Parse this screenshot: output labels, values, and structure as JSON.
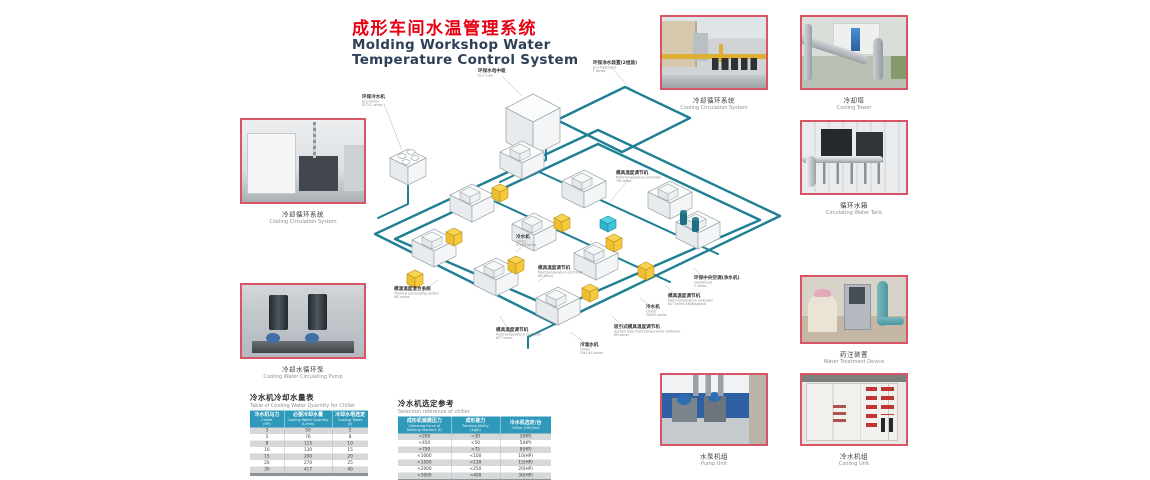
{
  "header": {
    "title_zh": "成形车间水温管理系统",
    "title_en1": "Molding Workshop Water",
    "title_en2": "Temperature Control System"
  },
  "colors": {
    "accent_red": "#e60012",
    "title_blue": "#2e4057",
    "photo_border": "#d95565",
    "pipe_teal": "#1e7f95",
    "controller_yellow": "#f2c53d",
    "table_header_blue": "#2e99ba"
  },
  "photos": [
    {
      "caption_zh": "冷却循环系统",
      "caption_en": "Cooling Circulation System"
    },
    {
      "caption_zh": "冷却水循环泵",
      "caption_en": "Cooling Water Circulating Pump"
    },
    {
      "caption_zh": "冷却循环系统",
      "caption_en": "Cooling Circulation System"
    },
    {
      "caption_zh": "冷却塔",
      "caption_en": "Cooling Tower"
    },
    {
      "caption_zh": "循环水箱",
      "caption_en": "Circulating Water Tank"
    },
    {
      "caption_zh": "药注装置",
      "caption_en": "Water Treatment Device"
    },
    {
      "caption_zh": "水泵机组",
      "caption_en": "Pump Unit"
    },
    {
      "caption_zh": "冷水机组",
      "caption_en": "Cooling Unit"
    }
  ],
  "diagram": {
    "labels": [
      {
        "zh": "环保净水装置(2组装)",
        "en1": "Eco-treatment",
        "en2": "F series"
      },
      {
        "zh": "环保水电中枢",
        "en1": "Eco Cube",
        "en2": ""
      },
      {
        "zh": "环保冷水机",
        "en1": "Eco-Chiller",
        "en2": "ECO-C series"
      },
      {
        "zh": "模具温度调节机",
        "en1": "Mold temperature controller",
        "en2": "TW series"
      },
      {
        "zh": "冷水机",
        "en1": "Chiller",
        "en2": "CH-KS series"
      },
      {
        "zh": "模具温度调节机",
        "en1": "Mold temperature controller",
        "en2": "KD series"
      },
      {
        "zh": "模温温度混合系统",
        "en1": "Thermal exchanging system",
        "en2": "IKS series"
      },
      {
        "zh": "模具温度调节机",
        "en1": "Mold temperature controller",
        "en2": "KCT series"
      },
      {
        "zh": "冷温水机",
        "en1": "Chiller",
        "en2": "CW-I-KS series"
      },
      {
        "zh": "冷水机",
        "en1": "Chiller",
        "en2": "CW-KS series"
      },
      {
        "zh": "吸引式模具温度调节机",
        "en1": "Suction type mold temperature controller",
        "en2": "KD series"
      },
      {
        "zh": "模具温度调节机",
        "en1": "Mold temperature controller",
        "en2": "KCT series 380N/special"
      },
      {
        "zh": "环保中央空调(净水机)",
        "en1": "Condensed",
        "en2": "C series"
      }
    ]
  },
  "tables": {
    "water": {
      "title_zh": "冷水机冷却水量表",
      "title_en": "Table of Cooling Water Quantity for Chiller",
      "headers": [
        {
          "zh": "冷水机马力",
          "en": "Chiller",
          "unit": "(HP)"
        },
        {
          "zh": "必要冷却水量",
          "en": "Cooling Water Quantity",
          "unit": "(L/min)"
        },
        {
          "zh": "冷却水塔选定",
          "en": "Cooling Tower",
          "unit": "(t)"
        }
      ],
      "rows": [
        [
          "3",
          "50",
          "5"
        ],
        [
          "5",
          "76",
          "8"
        ],
        [
          "8",
          "115",
          "10"
        ],
        [
          "10",
          "130",
          "15"
        ],
        [
          "15",
          "200",
          "20"
        ],
        [
          "20",
          "270",
          "25"
        ],
        [
          "30",
          "417",
          "40"
        ]
      ]
    },
    "select": {
      "title_zh": "冷水机选定参考",
      "title_en": "Selection reference of chiller",
      "headers": [
        {
          "zh": "成形机锁模压力",
          "en": "Clamping Force of",
          "unit": "Molding Machine (t)"
        },
        {
          "zh": "成形能力",
          "en": "Forming Ability",
          "unit": "(kg/h)"
        },
        {
          "zh": "冷水机选定/台",
          "en": "Chiller (HP)/Unit",
          "unit": ""
        }
      ],
      "rows": [
        [
          "<200",
          "<30",
          "3(HP)"
        ],
        [
          "<450",
          "<50",
          "5(HP)"
        ],
        [
          "<750",
          "<75",
          "8(HP)"
        ],
        [
          "<1000",
          "<100",
          "10(HP)"
        ],
        [
          "<1500",
          "<130",
          "15(HP)"
        ],
        [
          "<2000",
          "<250",
          "20(HP)"
        ],
        [
          "<3000",
          "<400",
          "30(HP)"
        ]
      ]
    }
  }
}
